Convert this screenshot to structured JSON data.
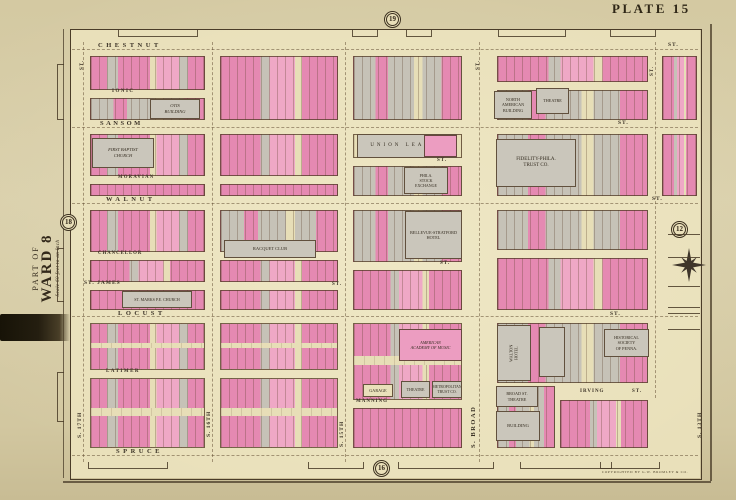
{
  "plate_title": "PLATE 15",
  "margin": {
    "part_of": "PART OF",
    "ward": "WARD 8",
    "scale": "Scale 60 feet to an Inch",
    "imprint": "COPYRIGHTED BY G.W. BROMLEY & CO."
  },
  "badges": {
    "top": "19",
    "bottom": "16",
    "left": "18",
    "right": "12"
  },
  "colors": {
    "paper": "#d6cca6",
    "field": "#e9e0ba",
    "pink": "#e589b2",
    "pink_light": "#efa8c6",
    "gray": "#c6c2b7",
    "cream": "#e7deb7",
    "ink": "#3a3020",
    "line": "#5a452e",
    "black_strip": "#1f1a10"
  },
  "map": {
    "street_labels": [
      {
        "t": "CHESTNUT",
        "x": 98,
        "y": 43,
        "s": 6.5,
        "sp": 3.5
      },
      {
        "t": "ST.",
        "x": 668,
        "y": 43,
        "s": 5.5,
        "sp": 1
      },
      {
        "t": "IONIC",
        "x": 112,
        "y": 89,
        "s": 5,
        "sp": 1.5
      },
      {
        "t": "SANSOM",
        "x": 100,
        "y": 121,
        "s": 6.5,
        "sp": 2.5
      },
      {
        "t": "ST.",
        "x": 618,
        "y": 121,
        "s": 5.5,
        "sp": 1
      },
      {
        "t": "MORAVIAN",
        "x": 118,
        "y": 176,
        "s": 4.8,
        "sp": 1.2
      },
      {
        "t": "ST.",
        "x": 437,
        "y": 158,
        "s": 5,
        "sp": 1
      },
      {
        "t": "WALNUT",
        "x": 106,
        "y": 197,
        "s": 6.5,
        "sp": 3.5
      },
      {
        "t": "ST.",
        "x": 652,
        "y": 197,
        "s": 5.5,
        "sp": 1
      },
      {
        "t": "CHANCELLOR",
        "x": 98,
        "y": 252,
        "s": 4.8,
        "sp": 1
      },
      {
        "t": "ST.",
        "x": 440,
        "y": 261,
        "s": 5,
        "sp": 1
      },
      {
        "t": "ST. JAMES",
        "x": 84,
        "y": 281,
        "s": 5.5,
        "sp": 1
      },
      {
        "t": "ST.",
        "x": 332,
        "y": 282,
        "s": 5,
        "sp": 1
      },
      {
        "t": "LOCUST",
        "x": 118,
        "y": 311,
        "s": 6.5,
        "sp": 3.5
      },
      {
        "t": "ST.",
        "x": 610,
        "y": 312,
        "s": 5.5,
        "sp": 1
      },
      {
        "t": "LATIMER",
        "x": 106,
        "y": 369,
        "s": 5,
        "sp": 1.5
      },
      {
        "t": "MANNING",
        "x": 356,
        "y": 399,
        "s": 5,
        "sp": 1
      },
      {
        "t": "IRVING",
        "x": 580,
        "y": 389,
        "s": 5,
        "sp": 1
      },
      {
        "t": "ST.",
        "x": 632,
        "y": 389,
        "s": 5,
        "sp": 1
      },
      {
        "t": "SPRUCE",
        "x": 116,
        "y": 449,
        "s": 6.5,
        "sp": 3.5
      },
      {
        "t": "S. 17TH",
        "x": 78,
        "y": 438,
        "s": 5.5,
        "sp": 1,
        "v": true
      },
      {
        "t": "ST.",
        "x": 80,
        "y": 70,
        "s": 5,
        "sp": 1,
        "v": true
      },
      {
        "t": "S. 16TH",
        "x": 207,
        "y": 437,
        "s": 5.5,
        "sp": 1,
        "v": true
      },
      {
        "t": "S. 15TH",
        "x": 340,
        "y": 447,
        "s": 5.5,
        "sp": 1,
        "v": true
      },
      {
        "t": "S. BROAD",
        "x": 471,
        "y": 448,
        "s": 6.5,
        "sp": 1.5,
        "v": true
      },
      {
        "t": "ST.",
        "x": 476,
        "y": 70,
        "s": 5,
        "sp": 1,
        "v": true
      },
      {
        "t": "ST.",
        "x": 650,
        "y": 76,
        "s": 5,
        "sp": 1,
        "v": true
      },
      {
        "t": "S. 13TH",
        "x": 698,
        "y": 438,
        "s": 5.5,
        "sp": 1,
        "v": true
      }
    ],
    "centerlines": {
      "h": [
        {
          "y": 49,
          "x1": 72,
          "x2": 698
        },
        {
          "y": 127,
          "x1": 72,
          "x2": 698
        },
        {
          "y": 203,
          "x1": 72,
          "x2": 698
        },
        {
          "y": 316,
          "x1": 72,
          "x2": 698
        },
        {
          "y": 455,
          "x1": 72,
          "x2": 698
        }
      ],
      "v": [
        {
          "x": 83,
          "y1": 42,
          "y2": 462
        },
        {
          "x": 212,
          "y1": 42,
          "y2": 462
        },
        {
          "x": 345,
          "y1": 42,
          "y2": 462
        },
        {
          "x": 479,
          "y1": 42,
          "y2": 462
        },
        {
          "x": 655,
          "y1": 42,
          "y2": 398
        }
      ]
    },
    "blocks": [
      {
        "x": 90,
        "y": 56,
        "w": 115,
        "h": 34,
        "fill": "mixA"
      },
      {
        "x": 90,
        "y": 98,
        "w": 115,
        "h": 22,
        "fill": "mixGray"
      },
      {
        "x": 220,
        "y": 56,
        "w": 118,
        "h": 64,
        "fill": "mixB"
      },
      {
        "x": 353,
        "y": 56,
        "w": 109,
        "h": 64,
        "fill": "mixGray"
      },
      {
        "x": 497,
        "y": 56,
        "w": 151,
        "h": 26,
        "fill": "mixB"
      },
      {
        "x": 497,
        "y": 90,
        "w": 151,
        "h": 30,
        "fill": "mixGray"
      },
      {
        "x": 662,
        "y": 56,
        "w": 35,
        "h": 64,
        "fill": "mixB"
      },
      {
        "x": 90,
        "y": 134,
        "w": 115,
        "h": 42,
        "fill": "mixA"
      },
      {
        "x": 90,
        "y": 184,
        "w": 115,
        "h": 12,
        "fill": "pink"
      },
      {
        "x": 220,
        "y": 134,
        "w": 118,
        "h": 42,
        "fill": "mixB"
      },
      {
        "x": 220,
        "y": 184,
        "w": 118,
        "h": 12,
        "fill": "pink"
      },
      {
        "x": 353,
        "y": 134,
        "w": 109,
        "h": 24,
        "fill": "cream"
      },
      {
        "x": 353,
        "y": 166,
        "w": 109,
        "h": 30,
        "fill": "mixGray"
      },
      {
        "x": 497,
        "y": 134,
        "w": 151,
        "h": 62,
        "fill": "mixGray"
      },
      {
        "x": 662,
        "y": 134,
        "w": 35,
        "h": 62,
        "fill": "mixB"
      },
      {
        "x": 90,
        "y": 210,
        "w": 115,
        "h": 42,
        "fill": "mixA"
      },
      {
        "x": 90,
        "y": 260,
        "w": 115,
        "h": 22,
        "fill": "mixB"
      },
      {
        "x": 90,
        "y": 290,
        "w": 115,
        "h": 20,
        "fill": "pink"
      },
      {
        "x": 220,
        "y": 210,
        "w": 118,
        "h": 42,
        "fill": "mixGray"
      },
      {
        "x": 220,
        "y": 260,
        "w": 118,
        "h": 22,
        "fill": "mixB"
      },
      {
        "x": 220,
        "y": 290,
        "w": 118,
        "h": 20,
        "fill": "mixB"
      },
      {
        "x": 353,
        "y": 210,
        "w": 109,
        "h": 52,
        "fill": "mixGray"
      },
      {
        "x": 353,
        "y": 270,
        "w": 109,
        "h": 40,
        "fill": "mixB"
      },
      {
        "x": 497,
        "y": 210,
        "w": 151,
        "h": 40,
        "fill": "mixGray"
      },
      {
        "x": 497,
        "y": 258,
        "w": 151,
        "h": 52,
        "fill": "mixB"
      },
      {
        "x": 90,
        "y": 323,
        "w": 115,
        "h": 47,
        "fill": "mixA",
        "split": true
      },
      {
        "x": 90,
        "y": 378,
        "w": 115,
        "h": 70,
        "fill": "mixA",
        "split": true
      },
      {
        "x": 220,
        "y": 323,
        "w": 118,
        "h": 47,
        "fill": "mixB",
        "split": true
      },
      {
        "x": 220,
        "y": 378,
        "w": 118,
        "h": 70,
        "fill": "mixB",
        "split": true
      },
      {
        "x": 353,
        "y": 323,
        "w": 109,
        "h": 77,
        "fill": "mixB",
        "split": true
      },
      {
        "x": 353,
        "y": 408,
        "w": 109,
        "h": 40,
        "fill": "pink"
      },
      {
        "x": 497,
        "y": 323,
        "w": 151,
        "h": 60,
        "fill": "mixGray"
      },
      {
        "x": 497,
        "y": 386,
        "w": 58,
        "h": 62,
        "fill": "mixGray"
      },
      {
        "x": 560,
        "y": 400,
        "w": 88,
        "h": 48,
        "fill": "mixB"
      }
    ],
    "buildings": [
      {
        "x": 150,
        "y": 99,
        "w": 50,
        "h": 20,
        "color": "g",
        "fs": 4.5,
        "italic": true,
        "lines": [
          "OTIS",
          "BUILDING"
        ]
      },
      {
        "x": 92,
        "y": 138,
        "w": 62,
        "h": 30,
        "color": "g",
        "fs": 4.5,
        "italic": true,
        "lines": [
          "FIRST BAPTIST",
          "CHURCH"
        ]
      },
      {
        "x": 357,
        "y": 134,
        "w": 100,
        "h": 24,
        "color": "g",
        "fs": 5,
        "sp": 3,
        "lines": [
          "UNION  LEAGUE"
        ]
      },
      {
        "x": 424,
        "y": 135,
        "w": 33,
        "h": 22,
        "color": "p",
        "lines": []
      },
      {
        "x": 404,
        "y": 167,
        "w": 44,
        "h": 27,
        "color": "g",
        "fs": 4,
        "lines": [
          "PHILA.",
          "STOCK",
          "EXCHANGE"
        ]
      },
      {
        "x": 496,
        "y": 139,
        "w": 80,
        "h": 48,
        "color": "g",
        "fs": 5,
        "lines": [
          "FIDELITY-PHILA.",
          "TRUST CO."
        ]
      },
      {
        "x": 405,
        "y": 211,
        "w": 57,
        "h": 48,
        "color": "g",
        "fs": 4.2,
        "lines": [
          "BELLEVUE-STRATFORD",
          "HOTEL"
        ]
      },
      {
        "x": 224,
        "y": 240,
        "w": 92,
        "h": 18,
        "color": "g",
        "fs": 4.5,
        "lines": [
          "RACQUET CLUB"
        ]
      },
      {
        "x": 122,
        "y": 291,
        "w": 70,
        "h": 17,
        "color": "g",
        "fs": 4,
        "lines": [
          "ST. MARKS P.E. CHURCH"
        ]
      },
      {
        "x": 399,
        "y": 329,
        "w": 63,
        "h": 32,
        "color": "p",
        "fs": 4.2,
        "italic": true,
        "lines": [
          "AMERICAN",
          "ACADEMY OF MUSIC"
        ]
      },
      {
        "x": 497,
        "y": 325,
        "w": 34,
        "h": 56,
        "color": "g",
        "fs": 4.2,
        "rot": -90,
        "lines": [
          "WALTON",
          "HOTEL"
        ]
      },
      {
        "x": 539,
        "y": 327,
        "w": 26,
        "h": 50,
        "color": "g",
        "lines": []
      },
      {
        "x": 604,
        "y": 329,
        "w": 45,
        "h": 28,
        "color": "g",
        "fs": 4.2,
        "lines": [
          "HISTORICAL",
          "SOCIETY",
          "OF PENNA."
        ]
      },
      {
        "x": 494,
        "y": 91,
        "w": 38,
        "h": 28,
        "color": "g",
        "fs": 4.2,
        "lines": [
          "NORTH",
          "AMERICAN",
          "BUILDING"
        ]
      },
      {
        "x": 536,
        "y": 88,
        "w": 33,
        "h": 26,
        "color": "g",
        "fs": 4.2,
        "lines": [
          "THEATRE"
        ]
      },
      {
        "x": 401,
        "y": 381,
        "w": 29,
        "h": 17,
        "color": "g",
        "fs": 4,
        "lines": [
          "THEATRE"
        ]
      },
      {
        "x": 432,
        "y": 381,
        "w": 30,
        "h": 17,
        "color": "g",
        "fs": 3.8,
        "lines": [
          "METROPOLITAN",
          "TRUST CO."
        ]
      },
      {
        "x": 363,
        "y": 384,
        "w": 30,
        "h": 13,
        "color": "c",
        "fs": 4.2,
        "lines": [
          "GARAGE"
        ]
      },
      {
        "x": 496,
        "y": 386,
        "w": 42,
        "h": 21,
        "color": "g",
        "fs": 4.2,
        "lines": [
          "BROAD ST.",
          "THEATRE"
        ]
      },
      {
        "x": 496,
        "y": 411,
        "w": 44,
        "h": 30,
        "color": "g",
        "fs": 4.5,
        "lines": [
          "BUILDING"
        ]
      }
    ]
  }
}
